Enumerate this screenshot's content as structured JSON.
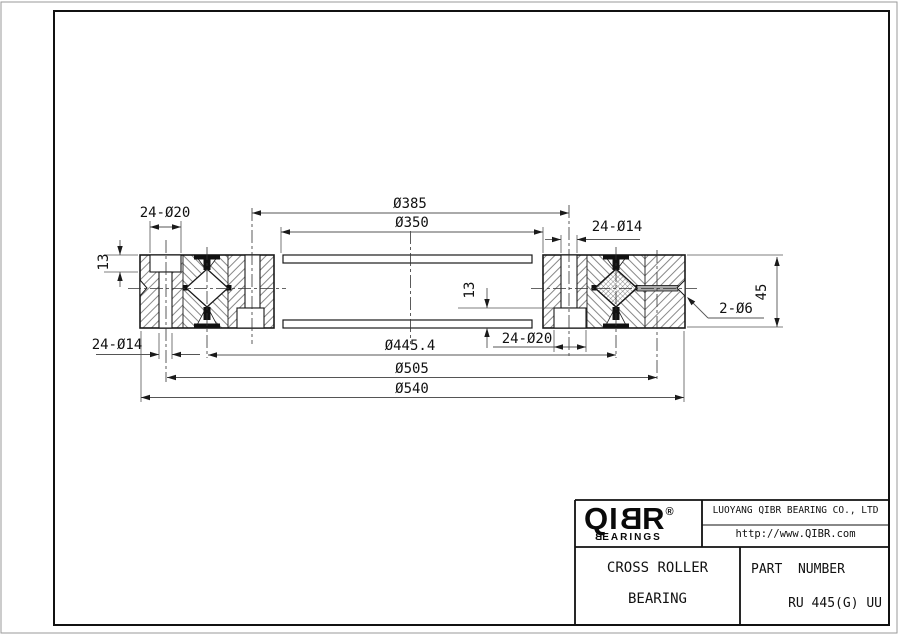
{
  "title_block": {
    "logo": {
      "brand": "QIBR",
      "registered": "®",
      "subtitle_b": "B",
      "subtitle_rest": "EARINGS"
    },
    "company": "LUOYANG QIBR BEARING CO., LTD",
    "website": "http://www.QIBR.com",
    "product": {
      "line1": "CROSS ROLLER",
      "line2": "BEARING"
    },
    "part_number_label": "PART  NUMBER",
    "part_number": "RU 445(G) UU"
  },
  "dimensions": {
    "counterbore_top_left": "24-Ø20",
    "ring_dia_outer": "Ø385",
    "ring_dia_inner": "Ø350",
    "holes_top_right": "24-Ø14",
    "counterbore_depth_left": "13",
    "counterbore_depth_right": "13",
    "holes_bottom_left": "24-Ø14",
    "roller_pitch_dia": "Ø445.4",
    "counterbore_bottom_right": "24-Ø20",
    "mount_circle_dia": "Ø505",
    "outer_dia": "Ø540",
    "grease_holes": "2-Ø6",
    "section_height": "45"
  }
}
